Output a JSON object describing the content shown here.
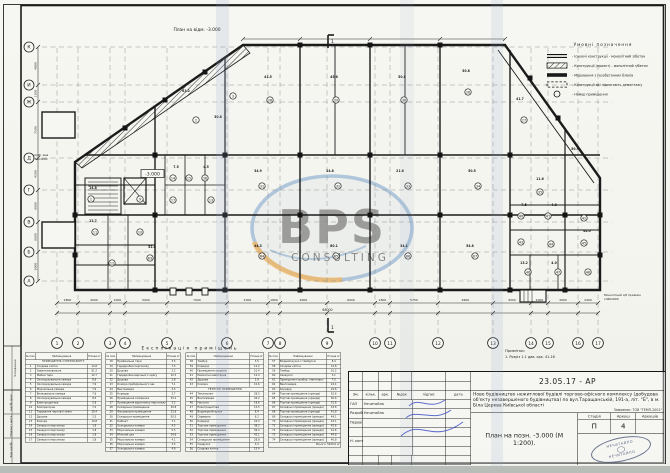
{
  "sheet": {
    "plan_label": "План на відм. -3.000",
    "note_title": "Примітки:",
    "note_line": "1. Розріз 1-1 див. арк. 41-16",
    "side_note_1": "Вигріб. яма",
    "side_note_2": "1750х1600",
    "entry_note_1": "Монолітний з/б приямок",
    "entry_note_2": "1460х600",
    "margin_labels": [
      "Узгоджено",
      "Інв.№ ориг.",
      "Підпис і дата",
      "Зам.інв.№"
    ],
    "section_mark": "1"
  },
  "watermark": {
    "main": "BPS",
    "sub": "CONSULTING",
    "blue": "#2f6fb4",
    "orange": "#ef9212"
  },
  "legend": {
    "title": "Умовні позначення",
    "items": [
      {
        "sym": "double-line",
        "label": "Існуючі конструкції - монолітний з/бетон"
      },
      {
        "sym": "hatch",
        "label": "Конструкції (проект) - монолітний з/бетон"
      },
      {
        "sym": "thick",
        "label": "Мурування з газобетонних блоків"
      },
      {
        "sym": "dash",
        "label": "Конструкції які підлягають демонтажу"
      },
      {
        "sym": "circle",
        "label": "Номер приміщення"
      }
    ]
  },
  "axes": {
    "letters": [
      {
        "t": "К",
        "y": 47
      },
      {
        "t": "И",
        "y": 85
      },
      {
        "t": "Ж",
        "y": 102
      },
      {
        "t": "Д",
        "y": 158
      },
      {
        "t": "Г",
        "y": 190
      },
      {
        "t": "В",
        "y": 222
      },
      {
        "t": "Б",
        "y": 252
      },
      {
        "t": "А",
        "y": 281
      }
    ],
    "left_dims": [
      "4800",
      "1500",
      "7500",
      "4500",
      "6000",
      "6000",
      "6000"
    ],
    "numbers": [
      {
        "t": "1",
        "x": 57
      },
      {
        "t": "2",
        "x": 78
      },
      {
        "t": "3",
        "x": 110
      },
      {
        "t": "4",
        "x": 125
      },
      {
        "t": "5",
        "x": 167
      },
      {
        "t": "6",
        "x": 227
      },
      {
        "t": "7",
        "x": 268
      },
      {
        "t": "8",
        "x": 280
      },
      {
        "t": "9",
        "x": 327
      },
      {
        "t": "10",
        "x": 375
      },
      {
        "t": "11",
        "x": 390
      },
      {
        "t": "12",
        "x": 438
      },
      {
        "t": "13",
        "x": 493
      },
      {
        "t": "14",
        "x": 531
      },
      {
        "t": "15",
        "x": 548
      },
      {
        "t": "16",
        "x": 578
      },
      {
        "t": "17",
        "x": 598
      }
    ],
    "bottom_dims": [
      "2800",
      "4000",
      "2000",
      "5000",
      "7000",
      "4300",
      "1800",
      "6000",
      "6000",
      "1800",
      "5750",
      "6600",
      "4500",
      "2000",
      "3600",
      "2400"
    ],
    "total_dim": "68000"
  },
  "plan": {
    "elevation": "-3.000",
    "area_labels": [
      {
        "t": "61.2",
        "x": 186,
        "y": 92
      },
      {
        "t": "30.8",
        "x": 218,
        "y": 118
      },
      {
        "t": "41.5",
        "x": 268,
        "y": 78
      },
      {
        "t": "45.6",
        "x": 334,
        "y": 78
      },
      {
        "t": "50.8",
        "x": 402,
        "y": 78
      },
      {
        "t": "30.8",
        "x": 466,
        "y": 72
      },
      {
        "t": "41.7",
        "x": 520,
        "y": 100
      },
      {
        "t": "50.9",
        "x": 575,
        "y": 150
      },
      {
        "t": "34.9",
        "x": 258,
        "y": 172
      },
      {
        "t": "24.8",
        "x": 330,
        "y": 172
      },
      {
        "t": "21.6",
        "x": 400,
        "y": 172
      },
      {
        "t": "50.5",
        "x": 472,
        "y": 172
      },
      {
        "t": "11.6",
        "x": 540,
        "y": 180
      },
      {
        "t": "52.8",
        "x": 152,
        "y": 248
      },
      {
        "t": "44.3",
        "x": 258,
        "y": 247
      },
      {
        "t": "80.1",
        "x": 334,
        "y": 247
      },
      {
        "t": "34.1",
        "x": 404,
        "y": 247
      },
      {
        "t": "54.8",
        "x": 470,
        "y": 247
      },
      {
        "t": "14.8",
        "x": 93,
        "y": 189
      },
      {
        "t": "12.7",
        "x": 93,
        "y": 222
      },
      {
        "t": "7.5",
        "x": 176,
        "y": 168
      },
      {
        "t": "4.5",
        "x": 206,
        "y": 168
      },
      {
        "t": "7.5",
        "x": 524,
        "y": 206
      },
      {
        "t": "4.8",
        "x": 554,
        "y": 206
      },
      {
        "t": "44.0",
        "x": 587,
        "y": 232
      },
      {
        "t": "13.2",
        "x": 524,
        "y": 264
      },
      {
        "t": "4.0",
        "x": 554,
        "y": 264
      }
    ],
    "room_circles": [
      {
        "n": "1",
        "x": 91,
        "y": 199
      },
      {
        "n": "11",
        "x": 95,
        "y": 232
      },
      {
        "n": "12",
        "x": 112,
        "y": 263
      },
      {
        "n": "9",
        "x": 140,
        "y": 199
      },
      {
        "n": "10",
        "x": 140,
        "y": 232
      },
      {
        "n": "14",
        "x": 173,
        "y": 178
      },
      {
        "n": "15",
        "x": 189,
        "y": 178
      },
      {
        "n": "16",
        "x": 205,
        "y": 178
      },
      {
        "n": "17",
        "x": 173,
        "y": 200
      },
      {
        "n": "13",
        "x": 211,
        "y": 200
      },
      {
        "n": "2",
        "x": 196,
        "y": 120
      },
      {
        "n": "3",
        "x": 233,
        "y": 96
      },
      {
        "n": "28",
        "x": 270,
        "y": 100
      },
      {
        "n": "29",
        "x": 336,
        "y": 100
      },
      {
        "n": "30",
        "x": 404,
        "y": 100
      },
      {
        "n": "26",
        "x": 468,
        "y": 92
      },
      {
        "n": "27",
        "x": 524,
        "y": 120
      },
      {
        "n": "31",
        "x": 262,
        "y": 186
      },
      {
        "n": "32",
        "x": 338,
        "y": 186
      },
      {
        "n": "33",
        "x": 408,
        "y": 186
      },
      {
        "n": "34",
        "x": 478,
        "y": 186
      },
      {
        "n": "35",
        "x": 540,
        "y": 192
      },
      {
        "n": "63",
        "x": 150,
        "y": 258
      },
      {
        "n": "64",
        "x": 262,
        "y": 256
      },
      {
        "n": "65",
        "x": 336,
        "y": 256
      },
      {
        "n": "66",
        "x": 408,
        "y": 256
      },
      {
        "n": "67",
        "x": 475,
        "y": 256
      },
      {
        "n": "40",
        "x": 521,
        "y": 216
      },
      {
        "n": "41",
        "x": 548,
        "y": 216
      },
      {
        "n": "42",
        "x": 584,
        "y": 218
      },
      {
        "n": "43",
        "x": 521,
        "y": 242
      },
      {
        "n": "44",
        "x": 551,
        "y": 244
      },
      {
        "n": "45",
        "x": 584,
        "y": 243
      },
      {
        "n": "46",
        "x": 528,
        "y": 272
      },
      {
        "n": "47",
        "x": 558,
        "y": 272
      },
      {
        "n": "48",
        "x": 588,
        "y": 272
      }
    ]
  },
  "explication": {
    "title": "Експлікація приміщень",
    "col_headers": [
      "№ пом.",
      "Найменування",
      "Площа м²"
    ],
    "tables": [
      {
        "rows": [
          {
            "s": "ПРИМІЩЕННЯ СУПЕРМАРКЕТУ"
          },
          [
            "1",
            "Сходова клітка",
            "14.8"
          ],
          [
            "2",
            "Завантажувальна",
            "61.2"
          ],
          [
            "3",
            "Мийна тари",
            "12.7"
          ],
          [
            "4",
            "Охолоджувальна камера",
            "8.6"
          ],
          [
            "5",
            "Охолоджувальна камера",
            "7.6"
          ],
          [
            "6",
            "Морозильна камера",
            "7.6"
          ],
          [
            "7",
            "Впакувальна камера",
            "7.6"
          ],
          [
            "8",
            "Охолоджувальна камера",
            "8.5"
          ],
          [
            "9",
            "Електрощитова",
            "5.8"
          ],
          [
            "10",
            "Компресорна",
            "7.2"
          ],
          [
            "11",
            "Тарування чергової зміни",
            "10.4"
          ],
          [
            "12",
            "Душова",
            "2.5"
          ],
          [
            "13",
            "Комора",
            "14.8"
          ],
          [
            "14",
            "Санвузол персоналу",
            "1.8"
          ],
          [
            "15",
            "Санвузол персоналу",
            "1.8"
          ],
          [
            "16",
            "Санвузол персоналу",
            "1.8"
          ],
          [
            "17",
            "Санвузол персоналу",
            "1.8"
          ]
        ]
      },
      {
        "rows": [
          [
            "18",
            "Приймальна тари",
            "3.5"
          ],
          [
            "19",
            "Гардеробна персоналу",
            "7.5"
          ],
          [
            "20",
            "Душова",
            "2.2"
          ],
          [
            "21",
            "Гардеробна верхнього одягу",
            "10.3"
          ],
          [
            "22",
            "Душова",
            "2.8"
          ],
          [
            "23",
            "Комора прибирального інв.",
            "7.1"
          ],
          [
            "24",
            "Венткамера",
            "4.5"
          ],
          [
            "25",
            "Коридор",
            "2.7"
          ],
          [
            "26",
            "Приміщення комірника",
            "34.1"
          ],
          [
            "27",
            "Приміщення відпочинку персоналу",
            "3.2"
          ],
          [
            "28",
            "Складське приміщення",
            "30.8"
          ],
          [
            "29",
            "Фасувальне приміщення",
            "21.6"
          ],
          [
            "30",
            "Складське приміщення",
            "50.5"
          ],
          [
            "31",
            "Кабінет",
            "7.1"
          ],
          [
            "32",
            "Холодильна камера",
            "4.5"
          ],
          [
            "33",
            "Морозильна камера",
            "5.5"
          ],
          [
            "34",
            "М'ясний цех",
            "24.6"
          ],
          [
            "35",
            "Морозильна камера",
            "4.1"
          ],
          [
            "36",
            "Морозильна камера",
            "3.5"
          ],
          [
            "37",
            "Холодильна камера",
            "4.6"
          ]
        ]
      },
      {
        "rows": [
          [
            "38",
            "Тамбур",
            "3.5"
          ],
          [
            "39",
            "Коридор",
            "12.2"
          ],
          [
            "40",
            "Приміщення охорони",
            "10.4"
          ],
          [
            "41",
            "Ремонтна майстерня",
            "12.4"
          ],
          [
            "42",
            "Душова",
            "2.8"
          ],
          [
            "43",
            "Комора",
            "10.6"
          ],
          {
            "s": "ТЕХНІЧНІ ПРИМІЩЕННЯ"
          },
          [
            "44",
            "Теплопункт",
            "28.5"
          ],
          [
            "45",
            "Венткамера",
            "42.2"
          ],
          [
            "46",
            "Насосна",
            "18.6"
          ],
          [
            "47",
            "Електрощитова",
            "12.5"
          ],
          [
            "48",
            "Водомірний вузол",
            "8.4"
          ],
          [
            "49",
            "Серверна",
            "6.2"
          ],
          [
            "50",
            "Коридор",
            "24.3"
          ],
          [
            "51",
            "Торгове приміщення",
            "38.2"
          ],
          [
            "52",
            "Торгове приміщення",
            "36.4"
          ],
          [
            "53",
            "Торгове приміщення",
            "42.1"
          ],
          [
            "54",
            "Складське приміщення",
            "28.8"
          ],
          [
            "55",
            "Санвузол",
            "3.2"
          ],
          [
            "56",
            "Сходова клітка",
            "15.4"
          ]
        ]
      },
      {
        "rows": [
          [
            "57",
            "Вхідний вузол з тамбуром",
            "8.4"
          ],
          [
            "58",
            "Сходова клітка",
            "12.8"
          ],
          [
            "59",
            "Тамбур",
            "10.2"
          ],
          [
            "60",
            "Санвузол",
            "3.1"
          ],
          [
            "61",
            "Приміщення прибир. інвентарю",
            "7.0"
          ],
          [
            "62",
            "Венткамера",
            "22.4"
          ],
          [
            "63",
            "Коридор",
            "24.8"
          ],
          [
            "64",
            "Торгові приміщення (оренда)",
            "52.6"
          ],
          [
            "65",
            "Торгові приміщення (оренда)",
            "50.6"
          ],
          [
            "66",
            "Торгові приміщення (оренда)",
            "51.6"
          ],
          [
            "67",
            "Складські приміщення (оренда)",
            "43.8"
          ],
          [
            "68",
            "Торгові приміщення (оренда)",
            "41.8"
          ],
          [
            "69",
            "Складські приміщення (оренда)",
            "44.1"
          ],
          [
            "70",
            "Складські приміщення (оренда)",
            "43.1"
          ],
          [
            "71",
            "Складські приміщення (оренда)",
            "42.6"
          ],
          [
            "72",
            "Складські приміщення (оренда)",
            "41.6"
          ],
          [
            "73",
            "Складські приміщення (оренда)",
            "44.8"
          ],
          [
            "74",
            "Складські приміщення (оренда)",
            "40.8"
          ],
          {
            "t": "Всього: 5930,0 м²"
          }
        ]
      }
    ]
  },
  "titleblock": {
    "code": "23.05.17 - АР",
    "project": "Нове будівництво нежитлової будівлі торгово-офісного комплексу (добудова об'єкту незавершеного будівництва) по вул.Таращанській, 191-а, літ. \"Б\", в м. Біла Церква Київської області",
    "client": "Замовник: ТОВ \"ТЕМП-2001\"",
    "sheet_title": "План на позн. -3.000 (М 1:200).",
    "stage_label": "Стадія",
    "sheet_label": "Аркуш",
    "sheets_label": "Аркушів",
    "stage": "П",
    "sheet_no": "4",
    "sheets_total": "",
    "cols": [
      "Зм.",
      "кільк.",
      "арк.",
      "№док",
      "підпис",
      "дата"
    ],
    "rows": [
      {
        "role": "ГАП",
        "name": "Нечитайло"
      },
      {
        "role": "Розроб.",
        "name": "Нечитайло"
      },
      {
        "role": "Перевір.",
        "name": ""
      },
      {
        "role": "",
        "name": ""
      },
      {
        "role": "Н. контр.",
        "name": ""
      },
      {
        "role": "",
        "name": ""
      }
    ],
    "stamp": "НЕЧИТАЙЛО"
  }
}
